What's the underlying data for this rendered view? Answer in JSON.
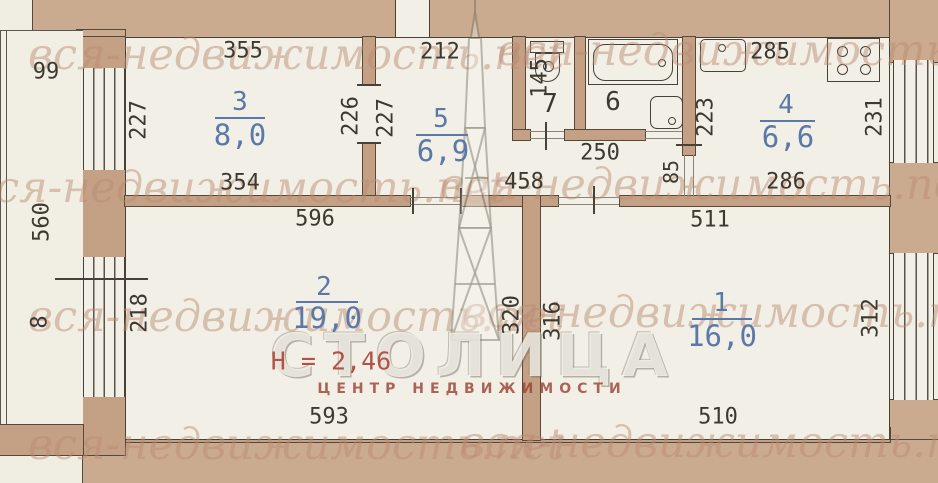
{
  "plan_type": "apartment-floor-plan",
  "colors": {
    "wall": "#c4a085",
    "paper": "#f0ede2",
    "room_fill": "#f2efe6",
    "label_blue": "#5b79a8",
    "label_red": "#b0544a",
    "line_dark": "#474138",
    "watermark": "#bb8970"
  },
  "watermark": {
    "tile_text": "вся-недвижимость.net",
    "logo_title": "СТОЛИЦА",
    "logo_subtitle": "ЦЕНТР НЕДВИЖИМОСТИ"
  },
  "rooms": {
    "r1": {
      "number": "1",
      "area": "16,0"
    },
    "r2": {
      "number": "2",
      "area": "19,0"
    },
    "r3": {
      "number": "3",
      "area": "8,0"
    },
    "r4": {
      "number": "4",
      "area": "6,6"
    },
    "r5": {
      "number": "5",
      "area": "6,9"
    },
    "r6": {
      "number": "6"
    },
    "r7": {
      "number": "7"
    }
  },
  "height_note": "Н = 2,46",
  "dims": {
    "d355": "355",
    "d212": "212",
    "d285": "285",
    "d354": "354",
    "d596": "596",
    "d458": "458",
    "d250": "250",
    "d286": "286",
    "d511": "511",
    "d593": "593",
    "d510": "510",
    "d99": "99",
    "d560": "560",
    "d8": "8",
    "d218": "218",
    "d227a": "227",
    "d226": "226",
    "d227b": "227",
    "d145": "145",
    "d223": "223",
    "d231": "231",
    "d85": "85",
    "d320": "320",
    "d316": "316",
    "d312": "312"
  }
}
